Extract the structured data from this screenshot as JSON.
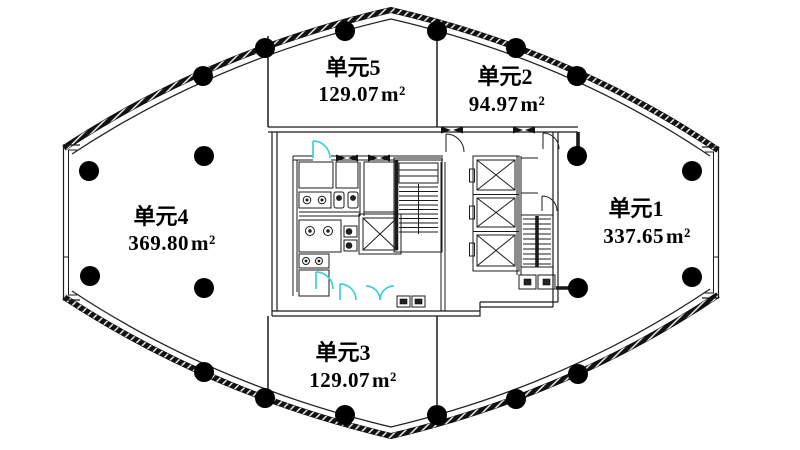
{
  "floor_plan": {
    "units": [
      {
        "key": "unit-1",
        "name": "单元1",
        "area_value": "337.65",
        "area_unit": "m²"
      },
      {
        "key": "unit-2",
        "name": "单元2",
        "area_value": "94.97",
        "area_unit": "m²"
      },
      {
        "key": "unit-3",
        "name": "单元3",
        "area_value": "129.07",
        "area_unit": "m²"
      },
      {
        "key": "unit-4",
        "name": "单元4",
        "area_value": "369.80",
        "area_unit": "m²"
      },
      {
        "key": "unit-5",
        "name": "单元5",
        "area_value": "129.07",
        "area_unit": "m²"
      }
    ],
    "columns_count": 20,
    "colors": {
      "line": "#1b1b1b",
      "door_accent": "#3ed0d6",
      "column_fill": "#000000",
      "background": "#ffffff"
    }
  }
}
